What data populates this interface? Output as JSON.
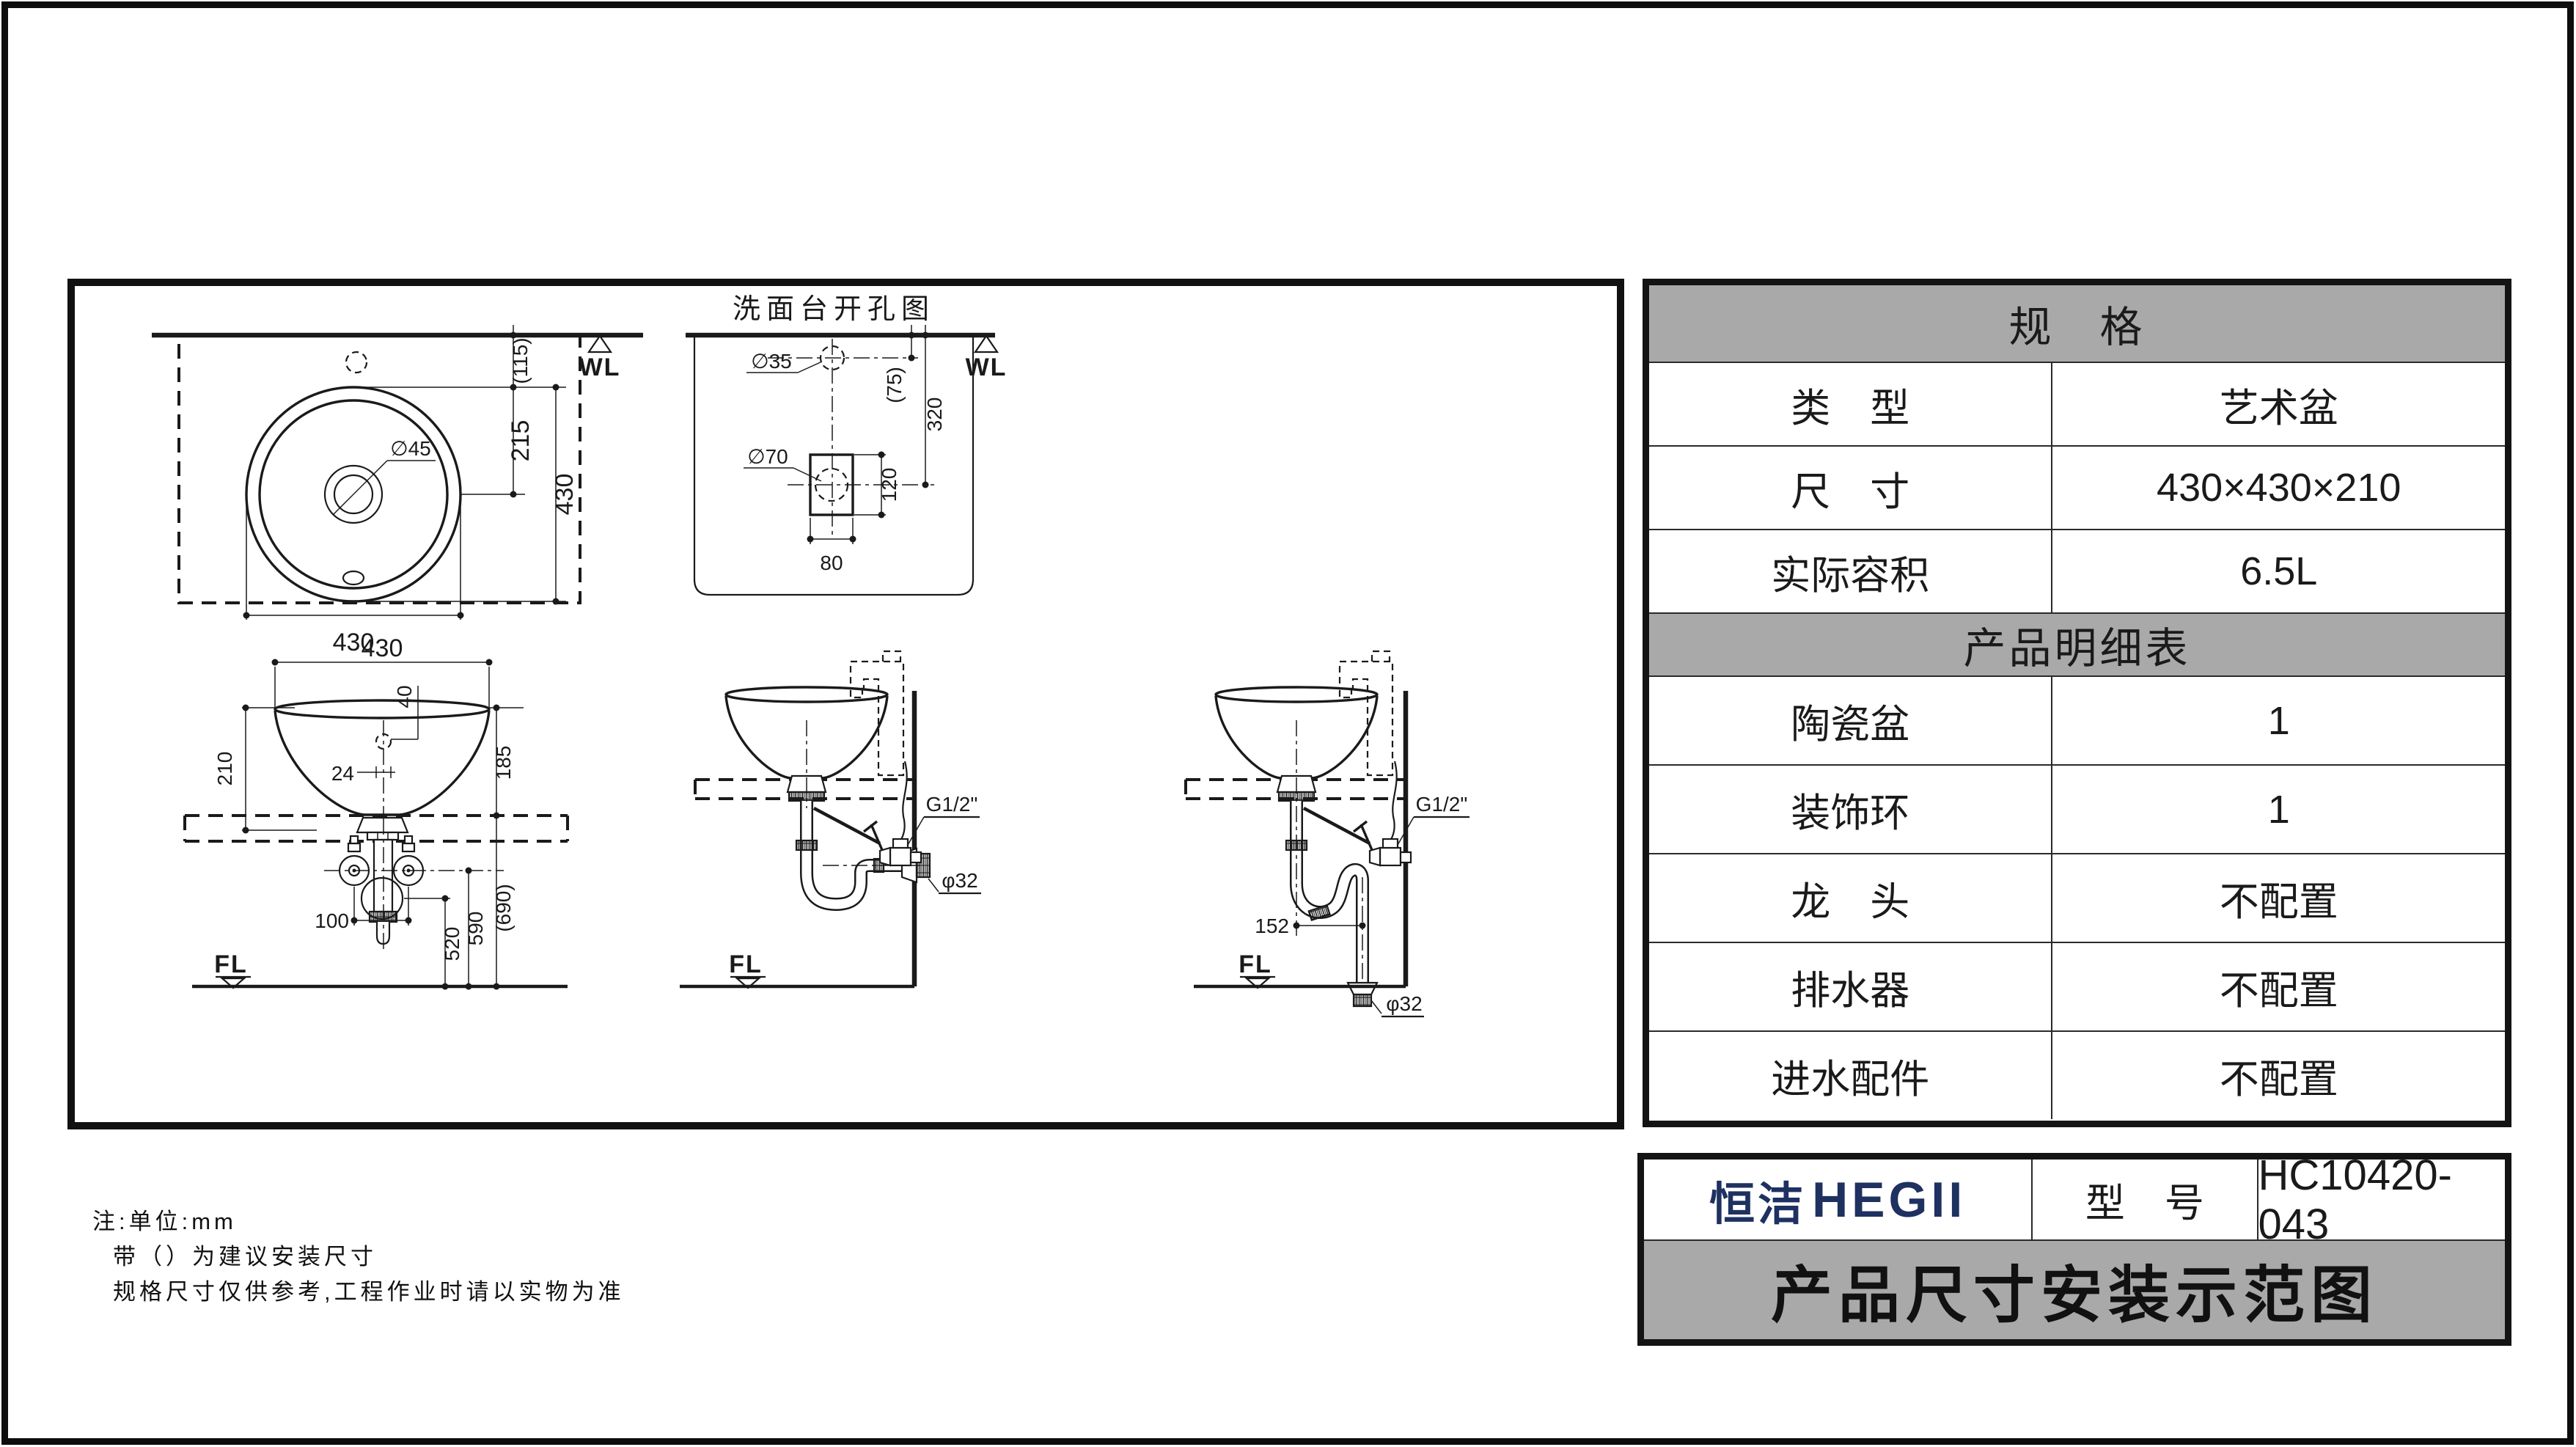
{
  "drawing": {
    "top_view": {
      "wl": "WL",
      "dim_115": "(115)",
      "dim_215": "215",
      "dim_430_v": "430",
      "dim_430_h": "430",
      "label_drain": "∅45"
    },
    "cutout": {
      "title": "洗面台开孔图",
      "wl": "WL",
      "label_hole35": "∅35",
      "label_hole70": "∅70",
      "dim_75": "(75)",
      "dim_320": "320",
      "dim_120": "120",
      "dim_80": "80"
    },
    "front_view": {
      "dim_430": "430",
      "dim_40": "40",
      "dim_24": "24",
      "dim_210": "210",
      "dim_185": "185",
      "dim_100": "100",
      "dim_520": "520",
      "dim_590": "590",
      "dim_690": "(690)",
      "fl": "FL"
    },
    "wall_drain_view": {
      "label_g12": "G1/2\"",
      "label_phi32": "φ32",
      "fl": "FL"
    },
    "floor_drain_view": {
      "label_g12": "G1/2\"",
      "dim_152": "152",
      "label_phi32": "φ32",
      "fl": "FL"
    }
  },
  "spec_table": {
    "header": "规　格",
    "rows": [
      {
        "label": "类　型",
        "value": "艺术盆"
      },
      {
        "label": "尺　寸",
        "value": "430×430×210"
      },
      {
        "label": "实际容积",
        "value": "6.5L"
      }
    ],
    "detail_header": "产品明细表",
    "detail_rows": [
      {
        "label": "陶瓷盆",
        "value": "1"
      },
      {
        "label": "装饰环",
        "value": "1"
      },
      {
        "label": "龙　头",
        "value": "不配置"
      },
      {
        "label": "排水器",
        "value": "不配置"
      },
      {
        "label": "进水配件",
        "value": "不配置"
      }
    ]
  },
  "title_block": {
    "brand_cn": "恒洁",
    "brand_en": "HEGII",
    "model_label": "型　号",
    "model_value": "HC10420-043",
    "doc_title": "产品尺寸安装示范图"
  },
  "notes": [
    "注:单位:mm",
    "带（）为建议安装尺寸",
    "规格尺寸仅供参考,工程作业时请以实物为准"
  ],
  "colors": {
    "header_gray": "#a9a9a9",
    "brand_navy": "#1e3160",
    "ink": "#1a1a1a"
  }
}
